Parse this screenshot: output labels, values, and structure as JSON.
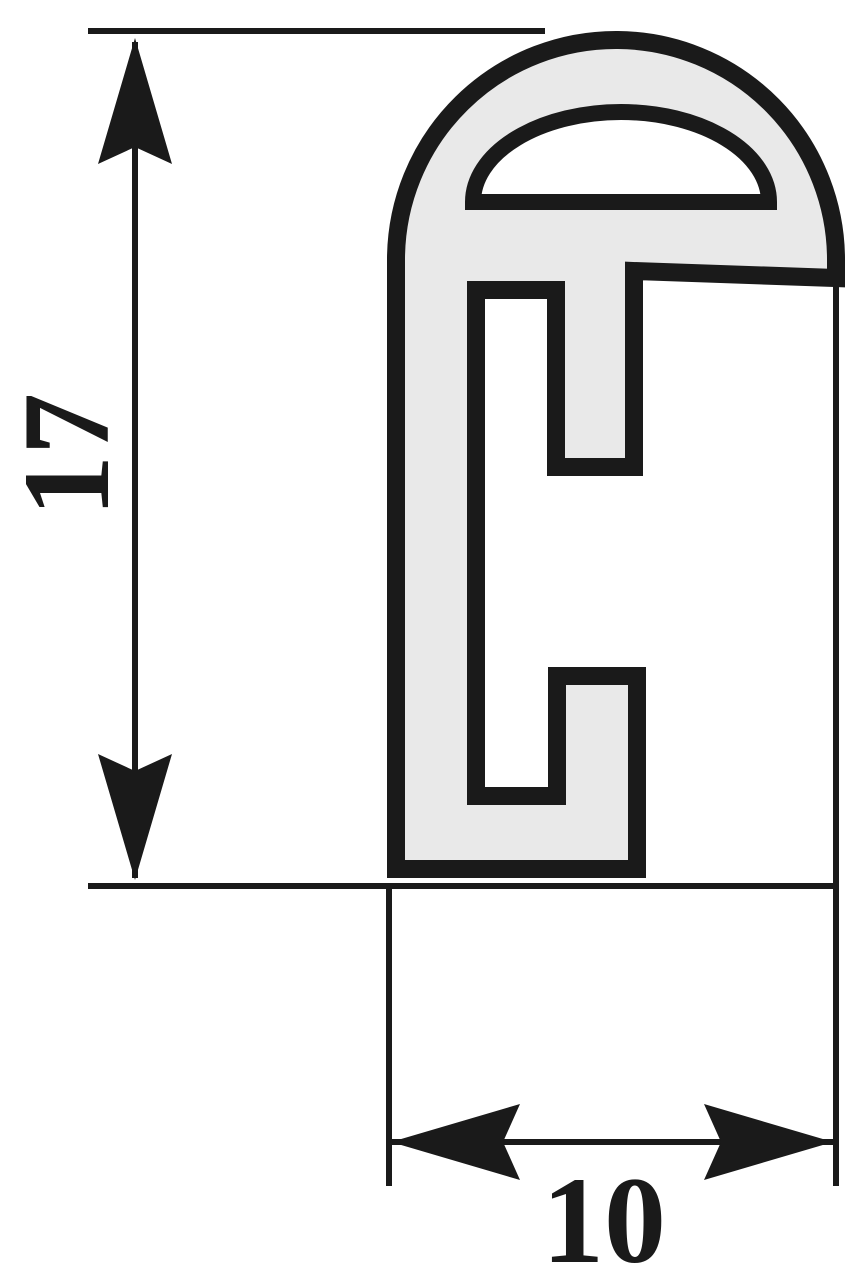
{
  "drawing": {
    "type": "technical-profile-cross-section",
    "background_color": "#ffffff",
    "line_color": "#1a1a1a",
    "profile_fill_color": "#e9e9e9",
    "profile_body_path": "M 396 869 L 396 258 A 220 220 0 0 1 836 262 L 836 278 L 634 271 L 634 467 L 556 467 L 556 290 L 476 290 L 476 796 L 557 796 L 557 676 L 637 676 L 637 869 Z",
    "window_cutout_path": "M 473 202 A 148 90 0 0 1 769 202 Z",
    "height_arrow_up_points": "135,38 172,164 135,147 98,164",
    "height_arrow_down_points": "135,880 172,754 135,771 98,754",
    "width_arrow_left_points": "391,1142 520,1104 503,1142 520,1180",
    "width_arrow_right_points": "833,1142 704,1104 721,1142 704,1180"
  },
  "dimensions": {
    "height": {
      "label": "17"
    },
    "width": {
      "label": "10"
    }
  }
}
